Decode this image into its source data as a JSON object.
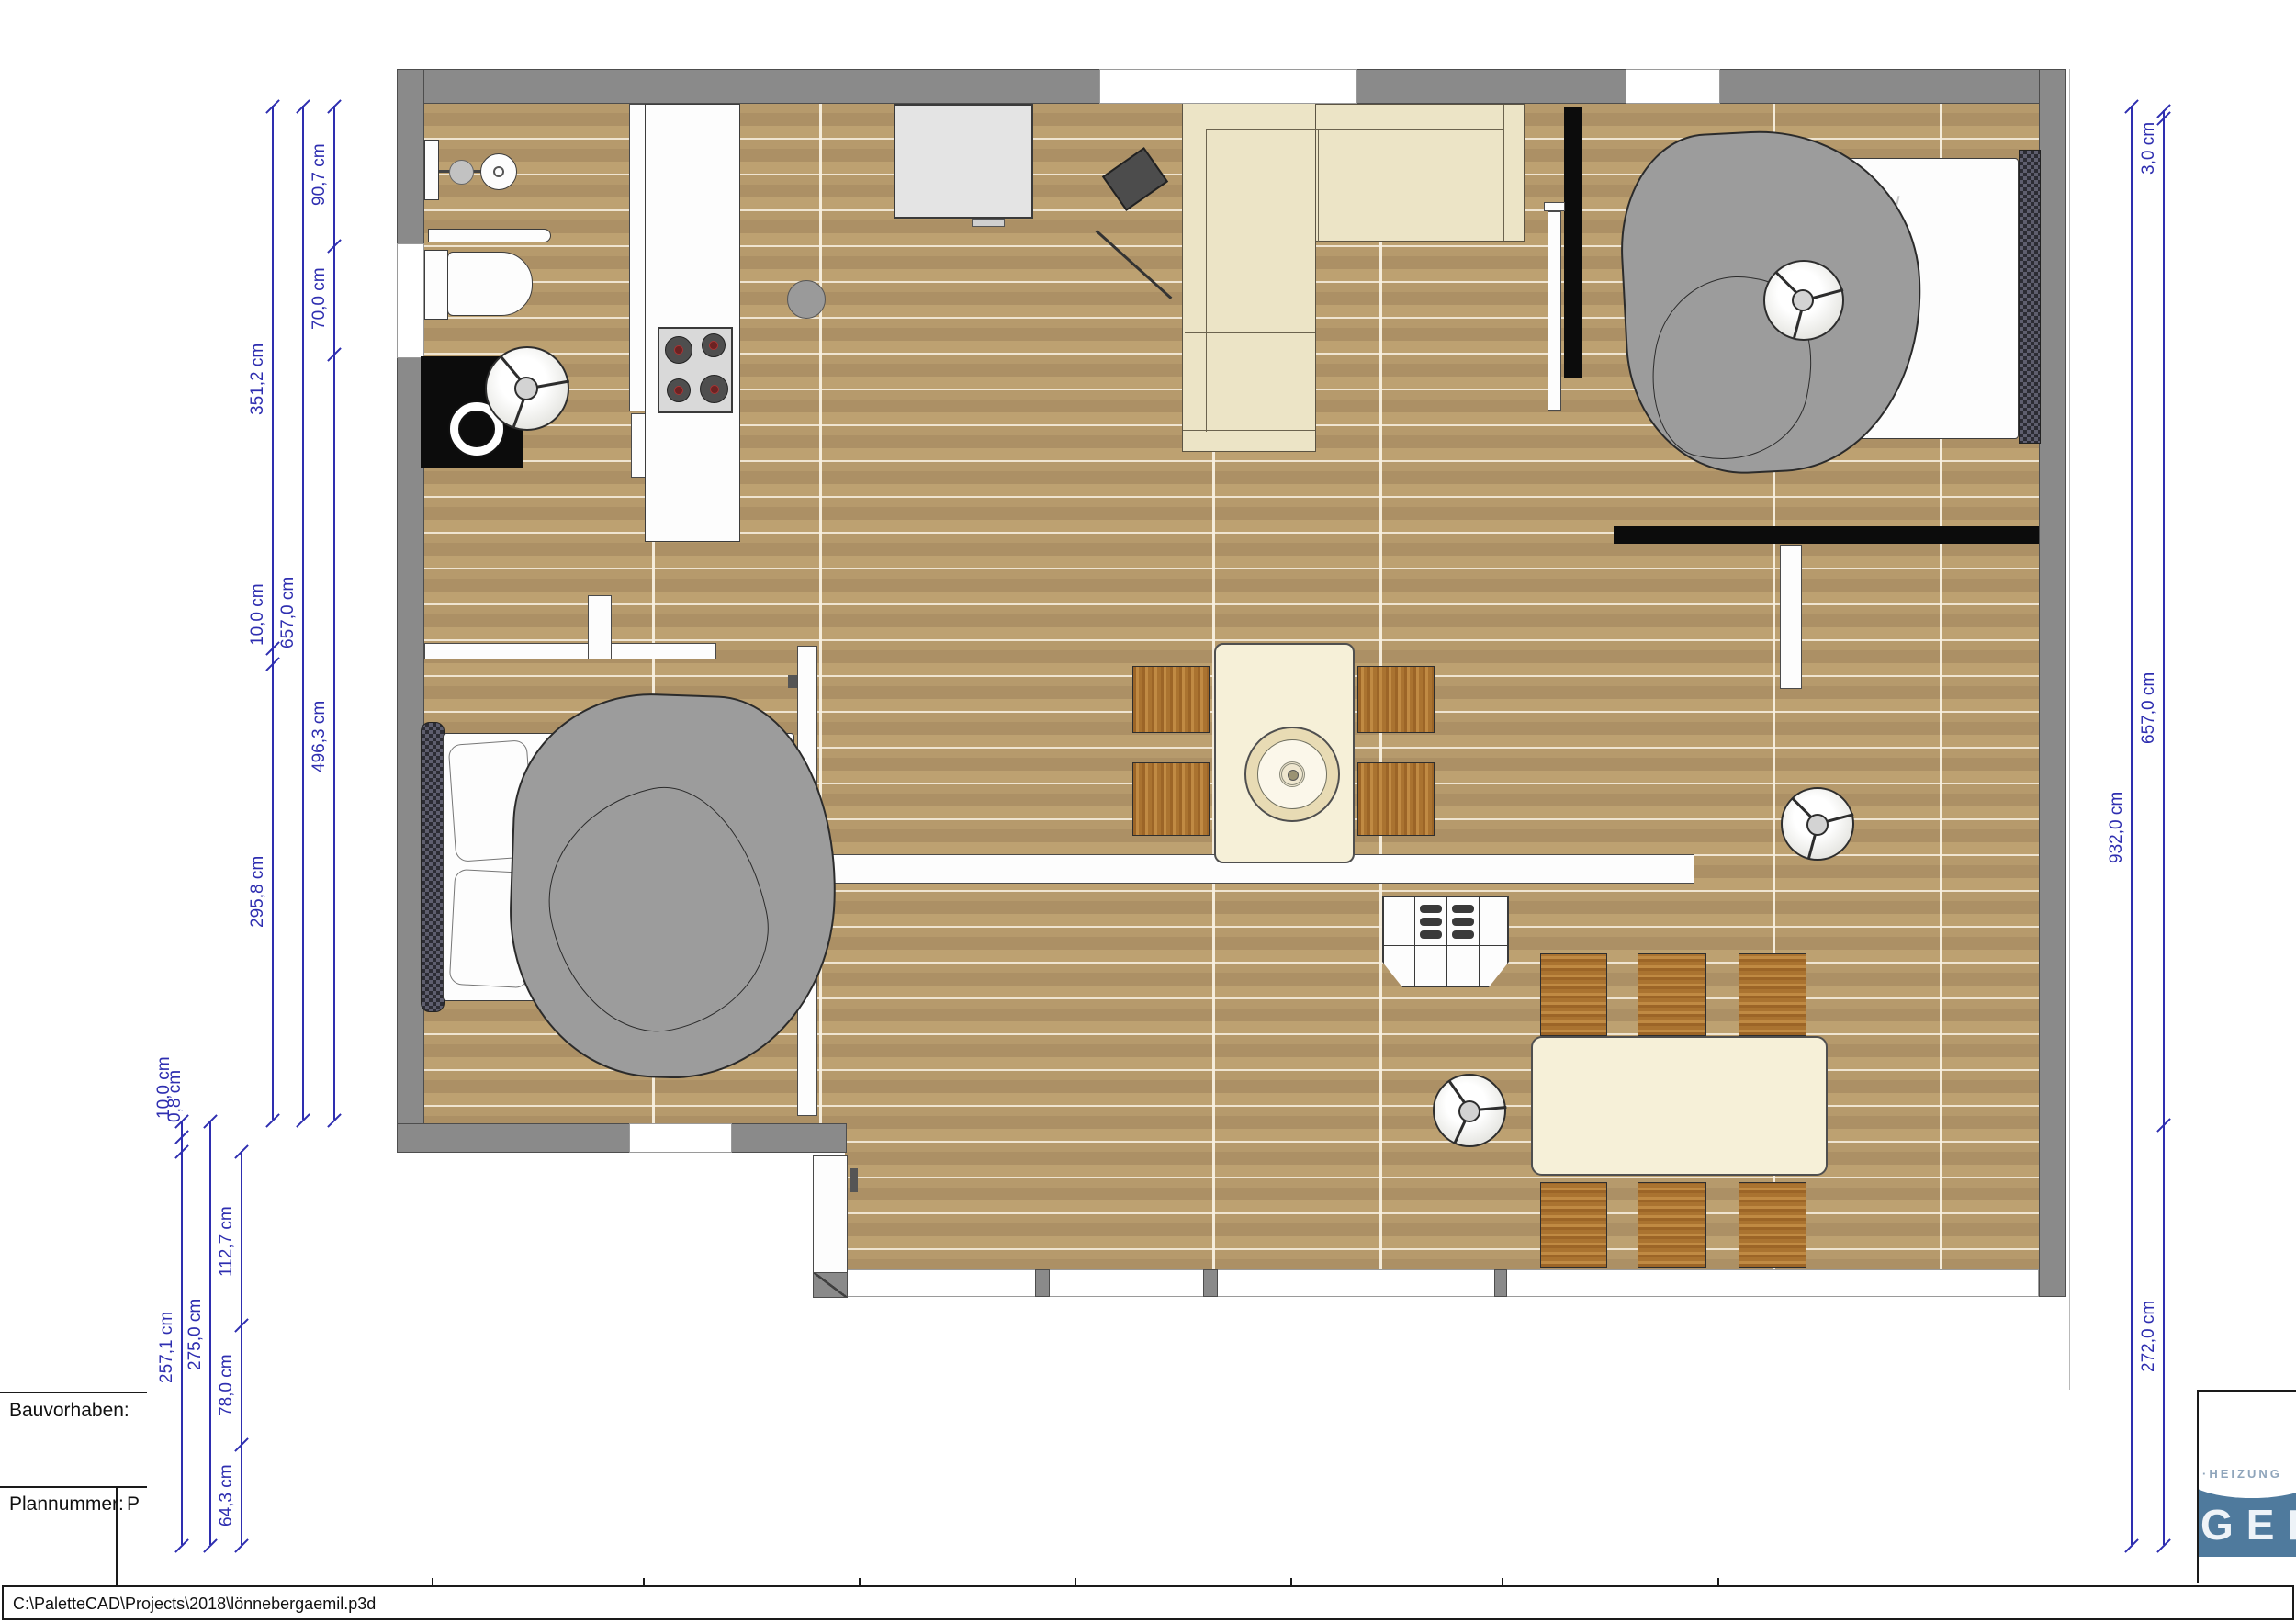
{
  "app": {
    "name": "PaletteCAD plan view",
    "status_path": "C:\\PaletteCAD\\Projects\\2018\\lönnebergaemil.p3d"
  },
  "title_block": {
    "bauvorhaben_label": "Bauvorhaben:",
    "plannummer_label": "Plannummer:",
    "plannummer_value": "P"
  },
  "logo": {
    "line1": "·HEIZUNG",
    "line2": "GER"
  },
  "dims": {
    "d351": "351,2 cm",
    "d10a": "10,0 cm",
    "d295": "295,8 cm",
    "d657l": "657,0 cm",
    "d90": "90,7 cm",
    "d70": "70,0 cm",
    "d496": "496,3 cm",
    "d10b": "10,0 cm",
    "d08": "0,8 cm",
    "d257": "257,1 cm",
    "d275": "275,0 cm",
    "d112": "112,7 cm",
    "d78": "78,0 cm",
    "d64": "64,3 cm",
    "d3": "3,0 cm",
    "d657r": "657,0 cm",
    "d272": "272,0 cm",
    "d932": "932,0 cm"
  },
  "colors": {
    "dimension_blue": "#2e2eb0",
    "wall_gray": "#8a8a8a",
    "interior_wall_black": "#0c0c0c",
    "floor_wood": "#b69a6c",
    "sofa_cream": "#ece4c6",
    "chair_wood": "#aa7330",
    "duvet_gray": "#9c9c9c",
    "logo_blue": "#4f7a9d"
  }
}
